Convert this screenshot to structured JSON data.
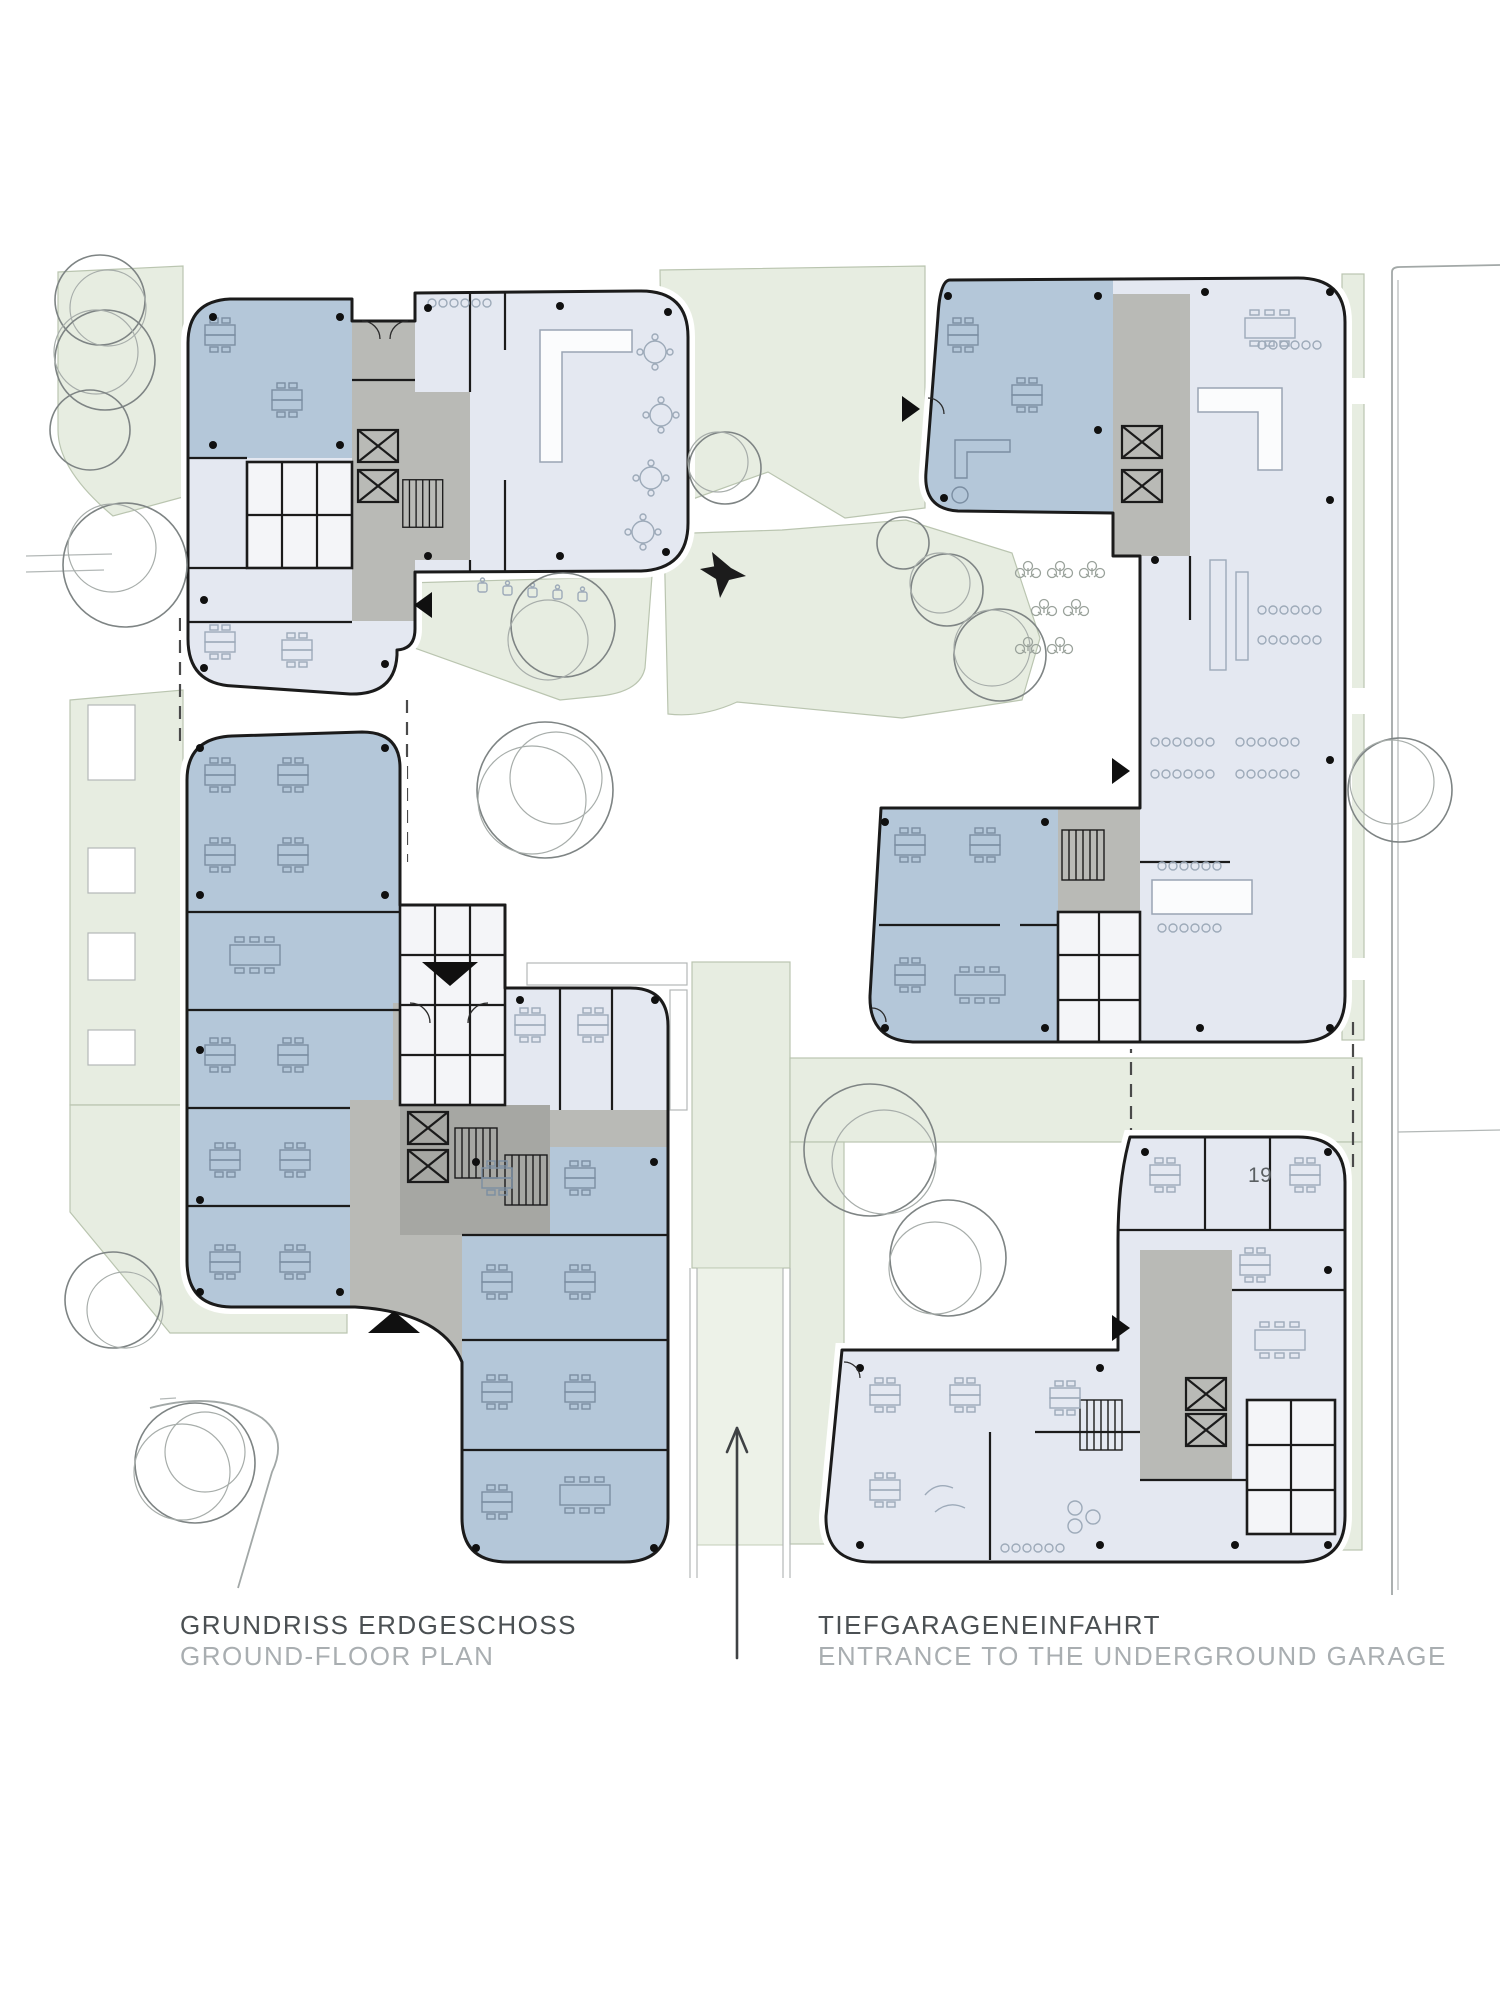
{
  "labels": {
    "floor_plan": {
      "title_de": "GRUNDRISS ERDGESCHOSS",
      "subtitle_en": "GROUND-FLOOR PLAN"
    },
    "garage": {
      "title_de": "TIEFGARAGENEINFAHRT",
      "subtitle_en": "ENTRANCE TO THE UNDERGROUND GARAGE"
    }
  },
  "plan": {
    "room_number_label": "19"
  },
  "colors": {
    "office_blue": "#b4c7d9",
    "neutral_room": "#e4e8f1",
    "circulation_core_gray": "#b9bab6",
    "landscape_green": "#e7ede1",
    "wall_black": "#1b1b1b",
    "label_dark": "#4b5053",
    "label_light": "#a9aeb1"
  },
  "icons": {
    "north_arrow": "north-arrow-icon",
    "garage_arrow": "garage-direction-arrow-icon",
    "entrance_marker": "entrance-triangle-marker",
    "tree": "tree-icon",
    "planting": "planting-icon"
  }
}
